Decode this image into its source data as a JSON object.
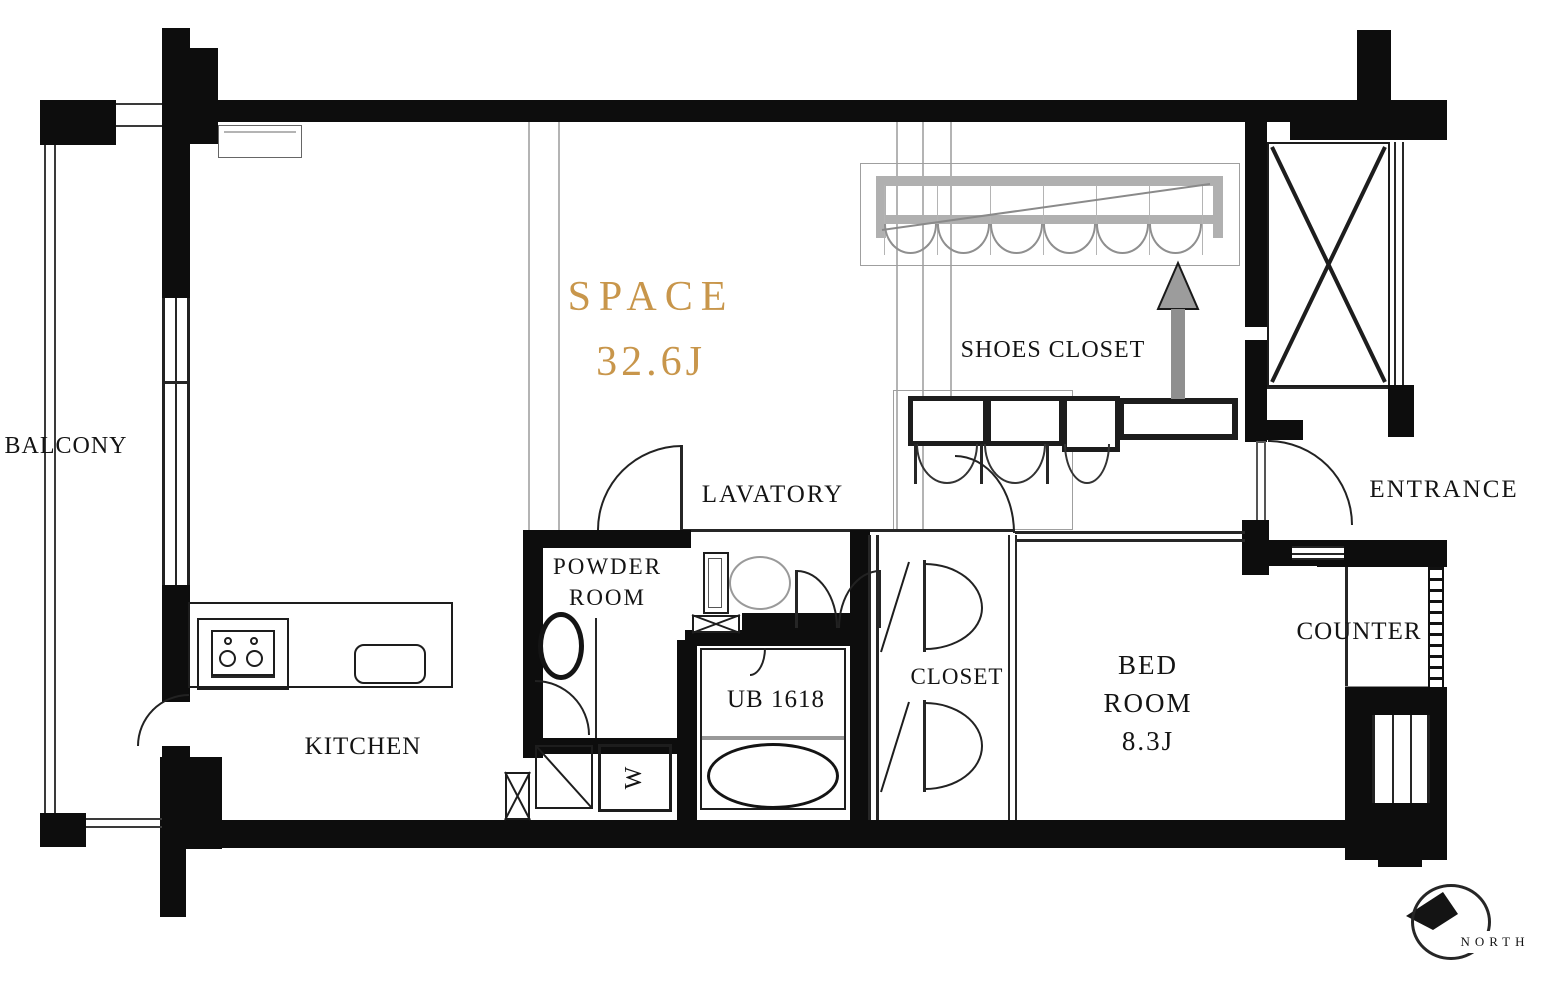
{
  "plan": {
    "rooms": {
      "balcony": "BALCONY",
      "space": "SPACE",
      "space_area": "32.6J",
      "lavatory": "LAVATORY",
      "powder_1": "POWDER",
      "powder_2": "ROOM",
      "shoes_closet": "SHOES CLOSET",
      "entrance": "ENTRANCE",
      "closet": "CLOSET",
      "unit_bath": "UB 1618",
      "bed_1": "BED",
      "bed_2": "ROOM",
      "bed_area": "8.3J",
      "kitchen": "KITCHEN",
      "counter": "COUNTER",
      "washer": "W"
    },
    "compass": {
      "north": "NORTH"
    },
    "colors": {
      "wall": "#0d0d0d",
      "space_accent": "#c8964b",
      "arrow_gray": "#8f8f8f"
    }
  }
}
